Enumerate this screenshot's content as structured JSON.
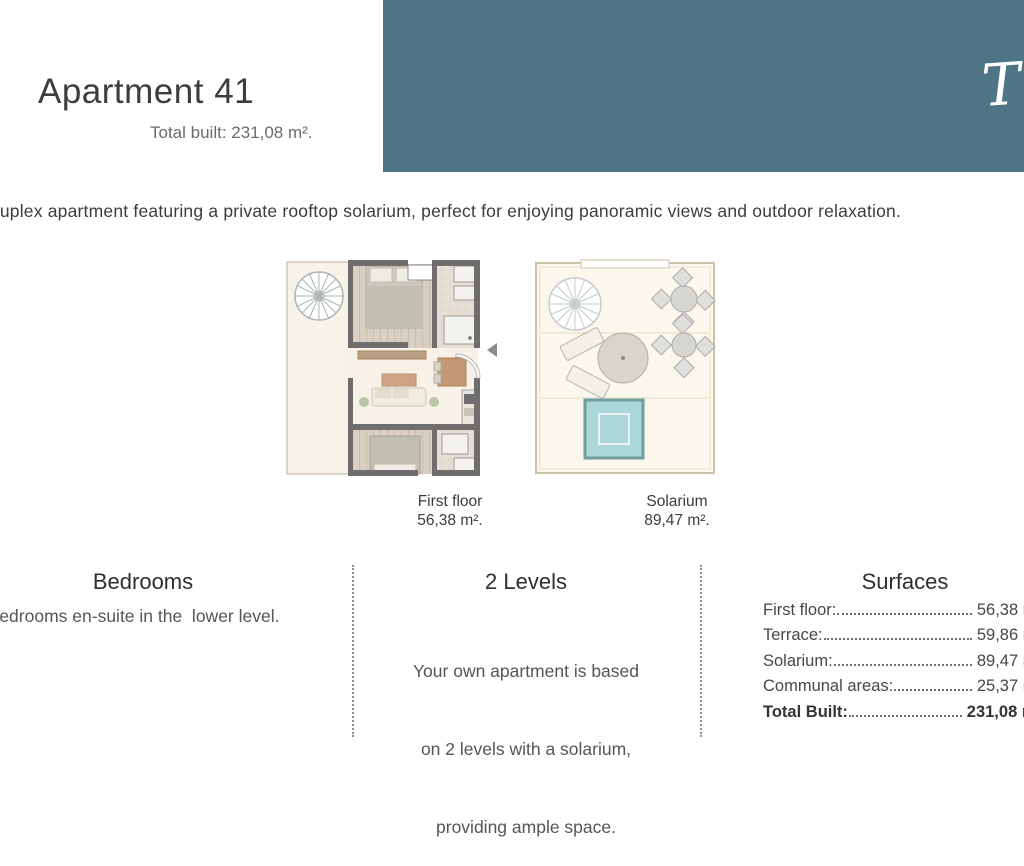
{
  "header": {
    "title": "Apartment 41",
    "subtitle": "Total built: 231,08 m².",
    "type_badge": "Type D"
  },
  "intro": {
    "description": "Duplex apartment featuring a private rooftop solarium, perfect for enjoying panoramic views and outdoor relaxation."
  },
  "floorplans": {
    "first_floor": {
      "label": "First floor",
      "area": "56,38 m²."
    },
    "solarium": {
      "label": "Solarium",
      "area": "89,47 m²."
    }
  },
  "info_columns": {
    "bedrooms": {
      "heading": "Bedrooms",
      "text": "2 bedrooms en-suite in the  lower level."
    },
    "levels": {
      "heading": "2 Levels",
      "line1": "Your own apartment is based",
      "line2": "on 2 levels with a solarium,",
      "line3": "providing ample space."
    },
    "surfaces": {
      "heading": "Surfaces",
      "rows": [
        {
          "label": "First floor:",
          "value": "56,38 m²"
        },
        {
          "label": "Terrace:",
          "value": "59,86 m²"
        },
        {
          "label": "Solarium:",
          "value": "89,47 m²"
        },
        {
          "label": "Communal areas:",
          "value": "25,37 m²"
        },
        {
          "label": "Total Built:",
          "value": "231,08 m²"
        }
      ]
    }
  },
  "colors": {
    "banner_teal": "#4d7585",
    "title_text": "#3d3d3d",
    "wall_gray": "#6f6e6c",
    "wood_floor": "#d9cfc3",
    "cream_floor": "#f7f1e7",
    "pool_blue": "#abd7d8"
  }
}
